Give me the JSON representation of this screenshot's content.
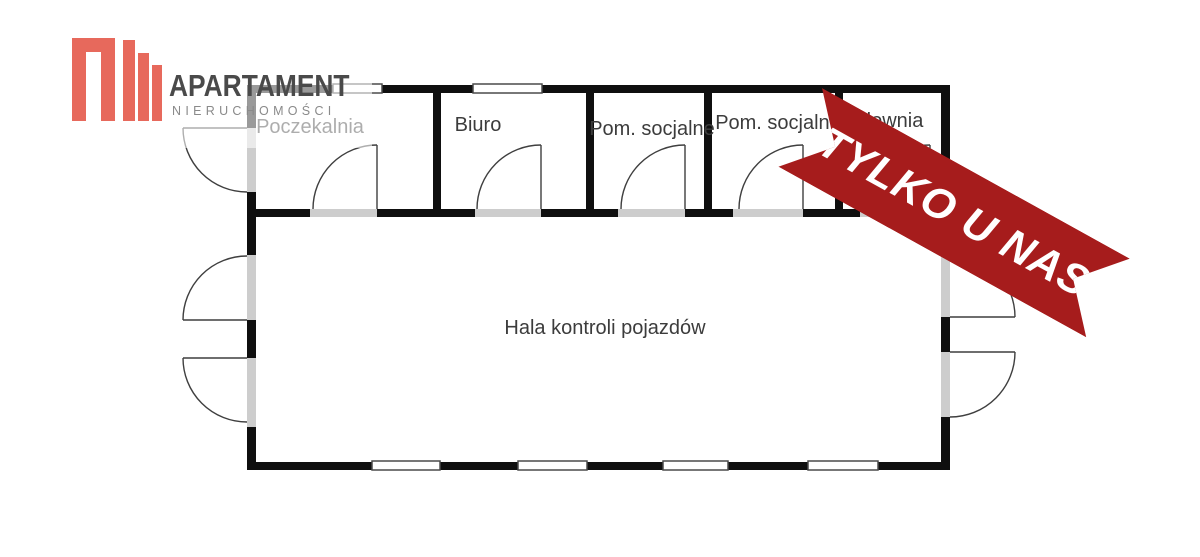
{
  "logo": {
    "brand": "APARTAMENT",
    "subtitle": "NIERUCHOMOŚCI",
    "accent_color": "#E7695C",
    "text_color": "#4A4A4A"
  },
  "banner": {
    "text": "TYLKO U NAS",
    "color": "#A61C1C"
  },
  "floor_plan": {
    "rooms": [
      {
        "label": "Poczekalnia"
      },
      {
        "label": "Biuro"
      },
      {
        "label": "Pom. socjalne"
      },
      {
        "label": "Pom. socjalne"
      },
      {
        "label": "Kotłownia"
      },
      {
        "label": "Hala kontroli pojazdów"
      }
    ]
  }
}
